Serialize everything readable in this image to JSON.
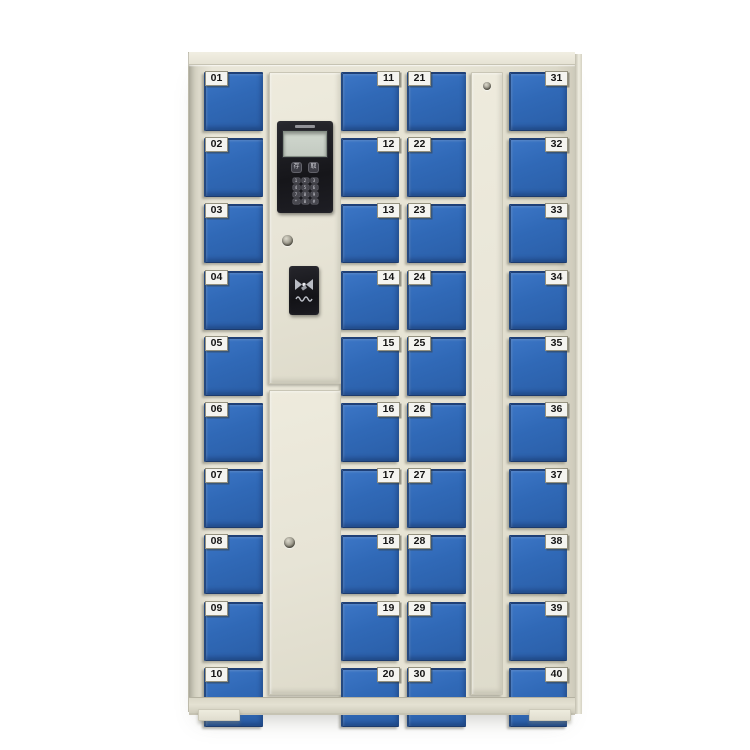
{
  "product": {
    "name": "smart storage locker cabinet",
    "door_count": 40
  },
  "columns": [
    {
      "name": "column-1",
      "label_side": "left",
      "doors": [
        "01",
        "02",
        "03",
        "04",
        "05",
        "06",
        "07",
        "08",
        "09",
        "10"
      ]
    },
    {
      "name": "column-2",
      "label_side": "right",
      "doors": [
        "11",
        "12",
        "13",
        "14",
        "15",
        "16",
        "17",
        "18",
        "19",
        "20"
      ]
    },
    {
      "name": "column-3",
      "label_side": "left",
      "doors": [
        "21",
        "22",
        "23",
        "24",
        "25",
        "26",
        "27",
        "28",
        "29",
        "30"
      ]
    },
    {
      "name": "column-4",
      "label_side": "right",
      "doors": [
        "31",
        "32",
        "33",
        "34",
        "35",
        "36",
        "37",
        "38",
        "39",
        "40"
      ]
    }
  ],
  "control_panel": {
    "function_keys": [
      "存",
      "取"
    ],
    "keypad": [
      "1",
      "2",
      "3",
      "4",
      "5",
      "6",
      "7",
      "8",
      "9",
      "*",
      "0",
      "#"
    ]
  },
  "icons": {
    "card_reader": "rfid-swipe-icon",
    "locks": "keyhole-lock-icon"
  },
  "colors": {
    "door_blue": "#306ab8",
    "cabinet_cream": "#e6e3d4",
    "panel_black": "#1c1c20",
    "screen_gray": "#c6cdc4",
    "label_bg": "#f4f4f0",
    "background": "#ffffff"
  }
}
